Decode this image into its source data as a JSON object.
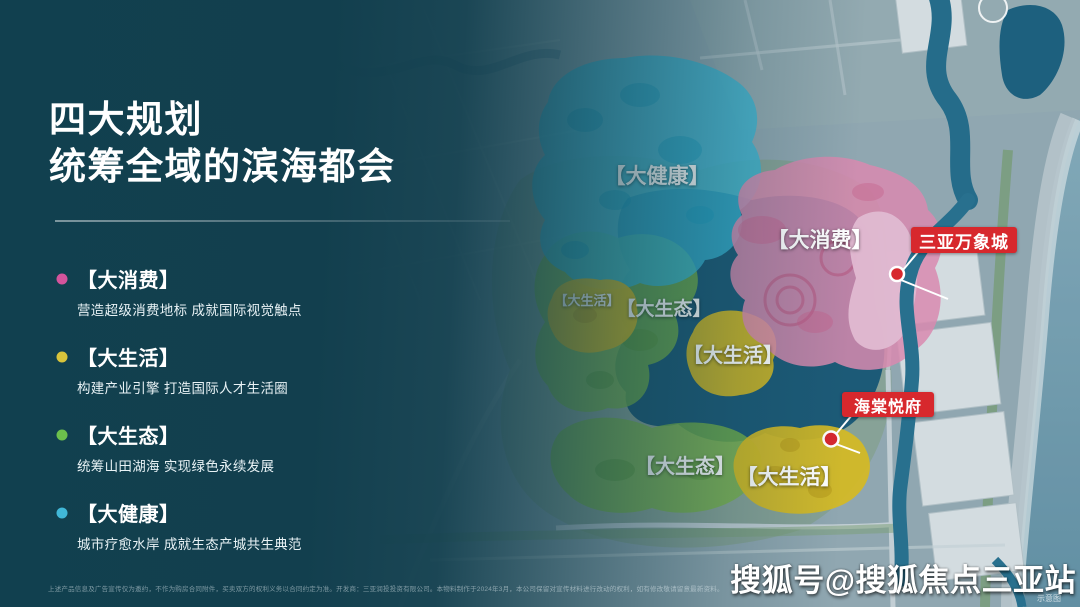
{
  "slide": {
    "title_line1": "四大规划",
    "title_line2": "统筹全域的滨海都会",
    "legend": [
      {
        "name": "【大消费】",
        "desc": "营造超级消费地标 成就国际视觉触点",
        "color": "#d4549c"
      },
      {
        "name": "【大生活】",
        "desc": "构建产业引擎 打造国际人才生活圈",
        "color": "#d8c43b"
      },
      {
        "name": "【大生态】",
        "desc": "统筹山田湖海 实现绿色永续发展",
        "color": "#6cc04c"
      },
      {
        "name": "【大健康】",
        "desc": "城市疗愈水岸 成就生态产城共生典范",
        "color": "#41b8d8"
      }
    ],
    "disclaimer": "上述产品信息及广告宣传仅为邀约，不作为购房合同附件，买卖双方的权利义务以合同约定为准。开发商：三亚润投投资有限公司。本物料制作于2024年3月，本公司保留对宣传材料进行改动的权利，如有修改敬请留意最新资料。"
  },
  "map": {
    "zone_labels": [
      {
        "text": "【大健康】"
      },
      {
        "text": "【大消费】"
      },
      {
        "text": "【大生活】"
      },
      {
        "text": "【大生态】"
      },
      {
        "text": "【大生活】"
      },
      {
        "text": "【大生态】"
      },
      {
        "text": "【大生活】"
      }
    ],
    "poi": [
      {
        "label": "三亚万象城"
      },
      {
        "label": "海棠悦府"
      }
    ],
    "note": "示意图",
    "zone_colors": {
      "health": "#3ec4e4",
      "consumption": "#f090b8",
      "consumption_highlight": "#f8c6de",
      "life": "#ecc71c",
      "ecology": "#84c043",
      "water": "#1d5c7a",
      "poi_red": "#d7282d"
    }
  },
  "watermark": "搜狐号@搜狐焦点三亚站"
}
